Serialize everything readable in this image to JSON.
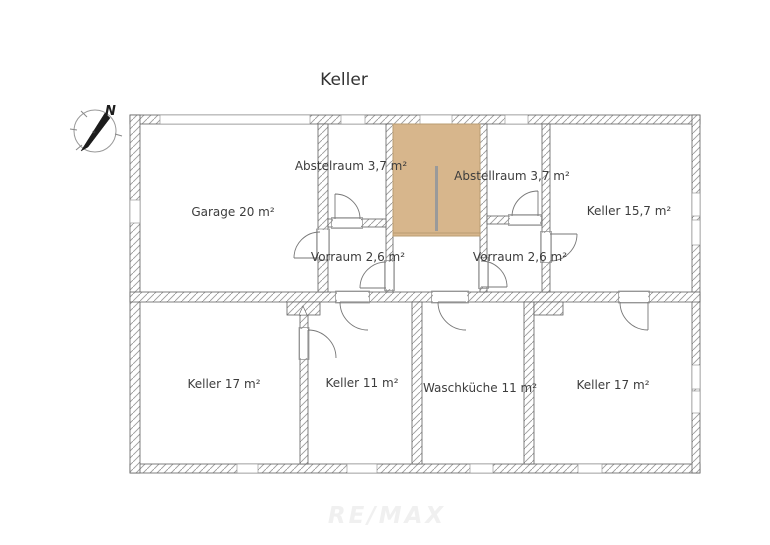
{
  "page": {
    "title": "Keller",
    "watermark": "RE/MAX"
  },
  "colors": {
    "stairs": "#d7b68c",
    "stairs-border": "#b89c72",
    "hatch": "#9b9b9b",
    "wall-outline": "#5f5f5f",
    "text": "#3d3d3d",
    "watermark": "#f0f0f0"
  },
  "rooms": {
    "garage": {
      "label": "Garage 20 m²"
    },
    "abstelraum_left": {
      "label": "Abstelraum 3,7 m²"
    },
    "vorraum_left": {
      "label": "Vorraum 2,6 m²"
    },
    "abstellraum_right": {
      "label": "Abstellraum 3,7 m²"
    },
    "vorraum_right": {
      "label": "Vorraum 2,6 m²"
    },
    "keller_157": {
      "label": "Keller 15,7 m²"
    },
    "keller_17_left": {
      "label": "Keller 17 m²"
    },
    "keller_11": {
      "label": "Keller 11 m²"
    },
    "waschkueche": {
      "label": "Waschküche 11 m²"
    },
    "keller_17_right": {
      "label": "Keller 17 m²"
    }
  },
  "compass": {
    "north": "N"
  }
}
